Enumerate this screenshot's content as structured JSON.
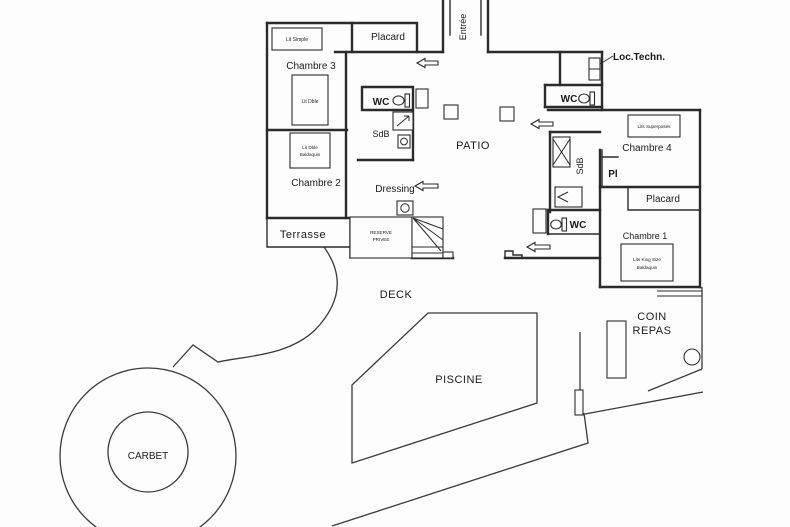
{
  "plan": {
    "rooms": {
      "chambre1": "Chambre 1",
      "chambre2": "Chambre 2",
      "chambre3": "Chambre 3",
      "chambre4": "Chambre 4",
      "placard_top": "Placard",
      "placard_right": "Placard",
      "pl": "Pl",
      "entree": "Entrée",
      "dressing": "Dressing",
      "loc_techn": "Loc.Techn.",
      "terrasse": "Terrasse",
      "wc_center": "WC",
      "wc_top_right": "WC",
      "wc_bottom_right": "WC",
      "sdb_center": "SdB",
      "sdb_right": "SdB",
      "reserve": {
        "line1": "RESERVE",
        "line2": "PRIVEE"
      }
    },
    "outdoor": {
      "patio": "PATIO",
      "deck": "DECK",
      "piscine": "PISCINE",
      "carbet": "CARBET",
      "coin_repas": {
        "line1": "COIN",
        "line2": "REPAS"
      }
    },
    "beds": {
      "lit_simple": "Lit Simple",
      "lit_dble": "Lit Dble",
      "lit_dble_baldaquin": {
        "line1": "Lit Dble",
        "line2": "Baldaquin"
      },
      "lits_superposes": "Lits Superposés",
      "lits_king": {
        "line1": "Lits King Size",
        "line2": "Baldaquin"
      }
    }
  }
}
